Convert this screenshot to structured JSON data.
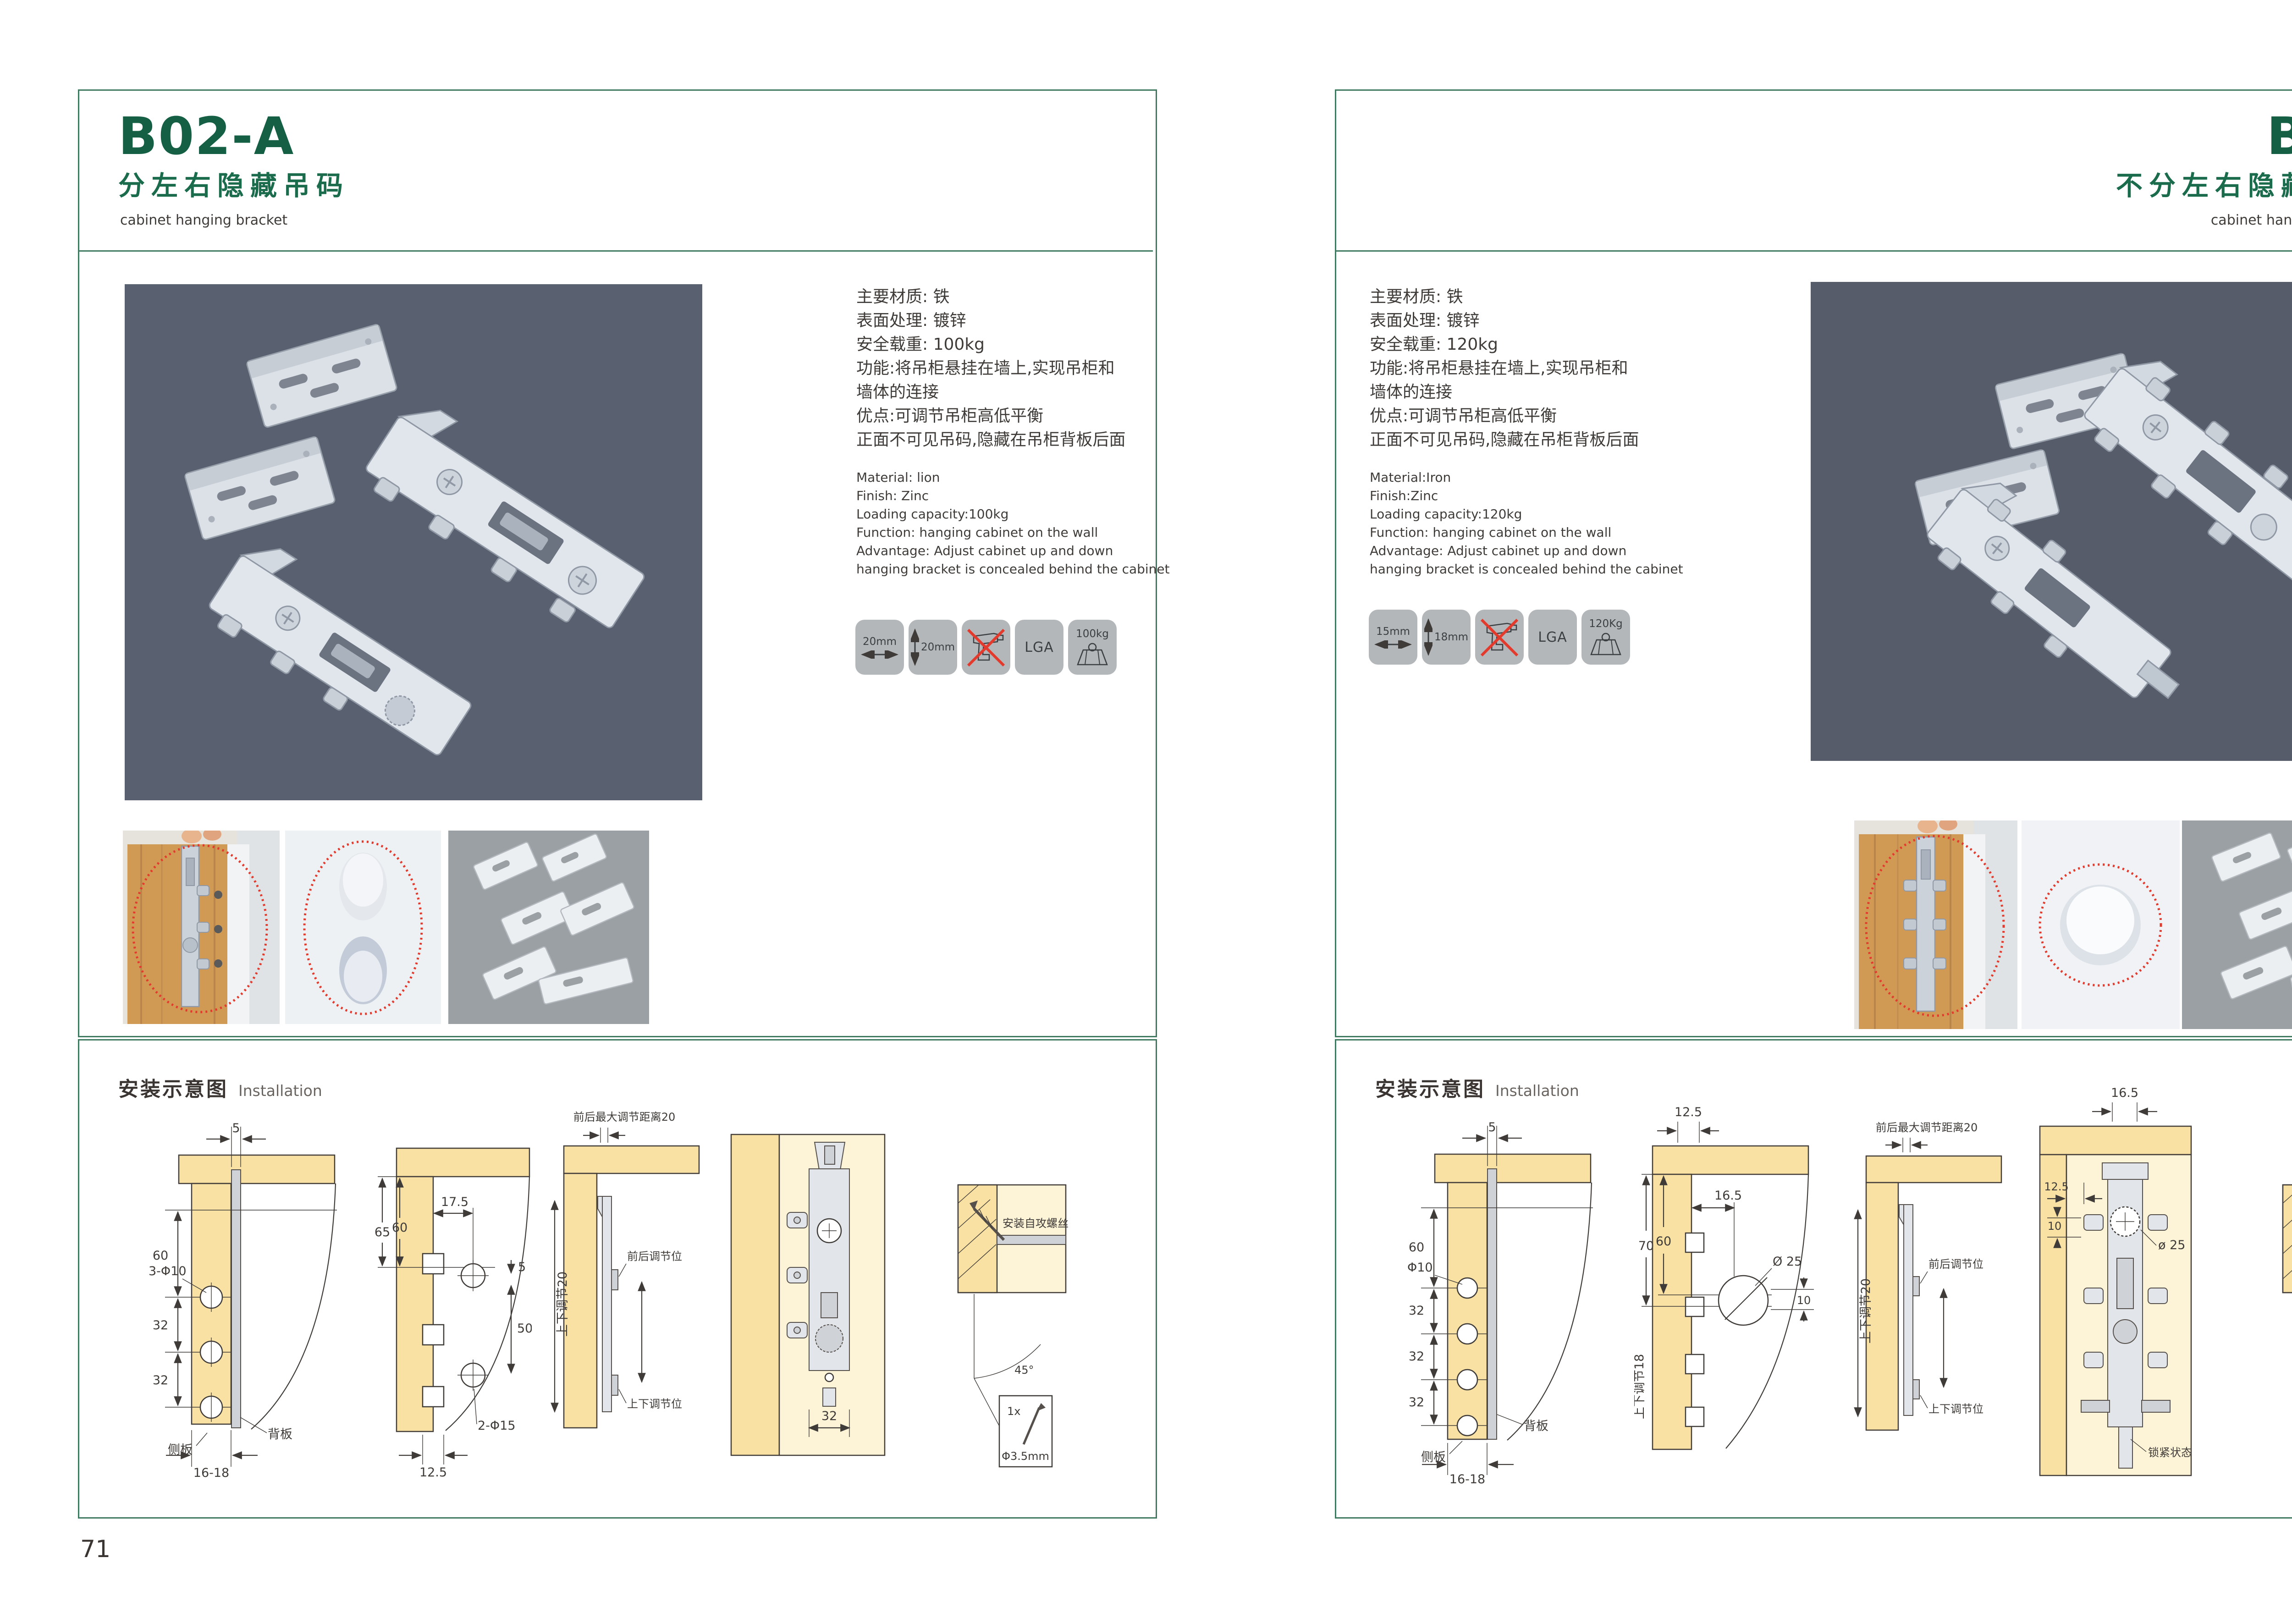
{
  "colors": {
    "green_title": "#155f45",
    "green_border": "#3f7a61",
    "badge_bg": "#b4b7ba",
    "highlight_red": "#e23b2e"
  },
  "pages": [
    {
      "page_number": "71",
      "code": "B02-A",
      "title_cn": "分左右隐藏吊码",
      "title_en": "cabinet hanging bracket",
      "specs_cn": [
        "主要材质: 铁",
        "表面处理: 镀锌",
        "安全载重: 100kg",
        "功能:将吊柜悬挂在墙上,实现吊柜和",
        "墙体的连接",
        "优点:可调节吊柜高低平衡",
        "正面不可见吊码,隐藏在吊柜背板后面"
      ],
      "specs_en": [
        "Material: lion",
        "Finish: Zinc",
        "Loading capacity:100kg",
        "Function: hanging cabinet on the wall",
        "Advantage: Adjust cabinet up and down",
        "hanging bracket is concealed behind the cabinet"
      ],
      "badges": {
        "width": "20mm",
        "height": "20mm",
        "cert": "LGA",
        "load": "100kg"
      },
      "install": {
        "title_cn": "安装示意图",
        "title_en": "Installation"
      },
      "d1": {
        "top": "5",
        "h1": "60",
        "holes": "3-Φ10",
        "s1": "32",
        "s2": "32",
        "side": "侧板",
        "back": "背板",
        "bottom": "16-18"
      },
      "d2": {
        "w": "17.5",
        "h1": "65",
        "h2": "60",
        "gap": "5",
        "span": "50",
        "holes": "2-Φ15",
        "bottom": "12.5"
      },
      "d3": {
        "top": "前后最大调节距离20",
        "vert": "上下调节20",
        "front": "前后调节位",
        "ud": "上下调节位"
      },
      "d4": {
        "w": "32"
      },
      "d5": {
        "screw": "安装自攻螺丝",
        "angle": "45°",
        "qty": "1x",
        "dia": "Φ3.5mm"
      }
    },
    {
      "page_number": "72",
      "code": "B03",
      "title_cn": "不分左右隐藏吊码",
      "title_en": "cabinet hanging bracket",
      "specs_cn": [
        "主要材质: 铁",
        "表面处理: 镀锌",
        "安全载重: 120kg",
        "功能:将吊柜悬挂在墙上,实现吊柜和",
        "墙体的连接",
        "优点:可调节吊柜高低平衡",
        "正面不可见吊码,隐藏在吊柜背板后面"
      ],
      "specs_en": [
        "Material:Iron",
        "Finish:Zinc",
        "Loading capacity:120kg",
        "Function: hanging cabinet on the wall",
        "Advantage: Adjust cabinet up and down",
        "hanging bracket is concealed behind the cabinet"
      ],
      "badges": {
        "width": "15mm",
        "height": "18mm",
        "cert": "LGA",
        "load": "120Kg"
      },
      "install": {
        "title_cn": "安装示意图",
        "title_en": "Installation"
      },
      "d1": {
        "top": "5",
        "h1": "60",
        "holes": "Φ10",
        "s1": "32",
        "s2": "32",
        "s3": "32",
        "side": "侧板",
        "back": "背板",
        "bottom": "16-18"
      },
      "d2": {
        "top": "12.5",
        "h1": "70",
        "h2": "60",
        "w": "16.5",
        "dia": "Ø 25",
        "off": "10",
        "vert": "上下调节18"
      },
      "d3": {
        "top": "前后最大调节距离20",
        "vert": "上下调节20",
        "front": "前后调节位",
        "ud": "上下调节位"
      },
      "d4": {
        "top": "16.5",
        "d125": "12.5",
        "d10": "10",
        "dia": "ø 25",
        "lock": "锁紧状态"
      },
      "d5": {
        "screw": "安装自攻螺丝",
        "angle": "45°",
        "qty": "1x",
        "dia": "Φ3.5mm"
      }
    }
  ]
}
